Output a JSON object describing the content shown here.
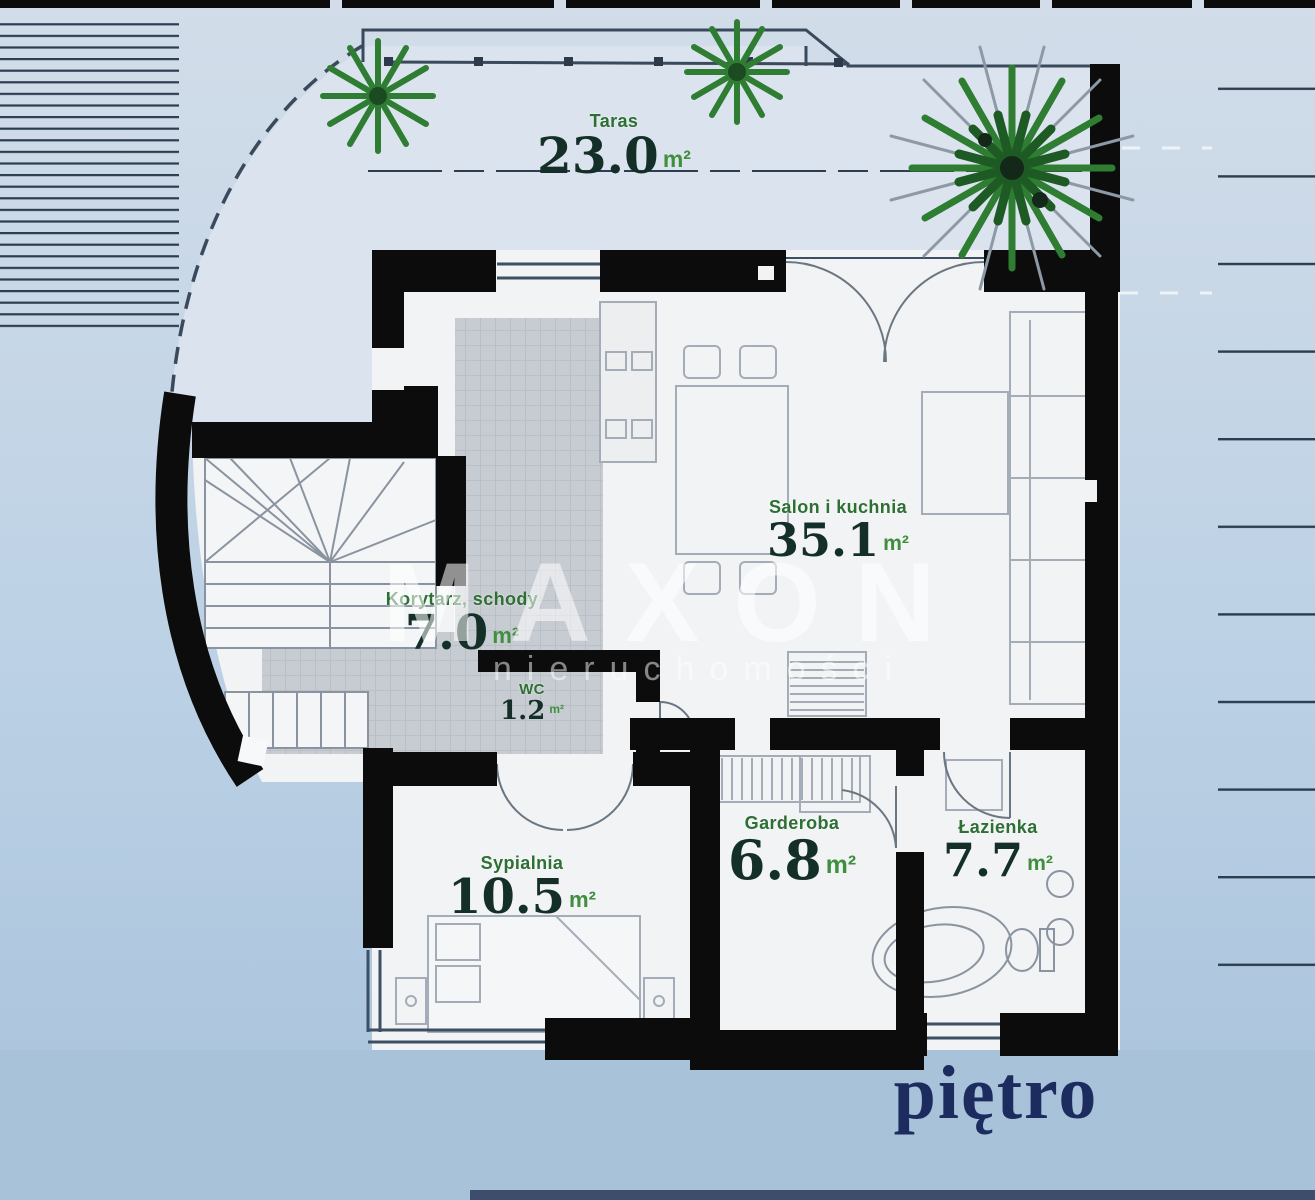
{
  "title": {
    "floor_label": "piętro"
  },
  "watermark": {
    "line1": "MAXON",
    "line2": "nieruchomości"
  },
  "unit_suffix": "m²",
  "rooms": [
    {
      "id": "taras",
      "name": "Taras",
      "area": "23.0"
    },
    {
      "id": "salon",
      "name": "Salon i kuchnia",
      "area": "35.1"
    },
    {
      "id": "korytarz",
      "name": "Korytarz, schody",
      "area": "7.0"
    },
    {
      "id": "wc",
      "name": "WC",
      "area": "1.2"
    },
    {
      "id": "sypialnia",
      "name": "Sypialnia",
      "area": "10.5"
    },
    {
      "id": "garderoba",
      "name": "Garderoba",
      "area": "6.8"
    },
    {
      "id": "lazienka",
      "name": "Łazienka",
      "area": "7.7"
    }
  ],
  "colors": {
    "wall": "#0c0c0c",
    "room_name_green": "#2e6f34",
    "area_number_dark": "#142f27",
    "unit_green": "#3f8f3f",
    "floor_title_navy": "#1d2c5f",
    "background_blue": "#b9cee3",
    "terrace_blue": "#dbe4ee",
    "tile_gray": "#c7ccd2",
    "watermark_white": "#ffffff"
  }
}
